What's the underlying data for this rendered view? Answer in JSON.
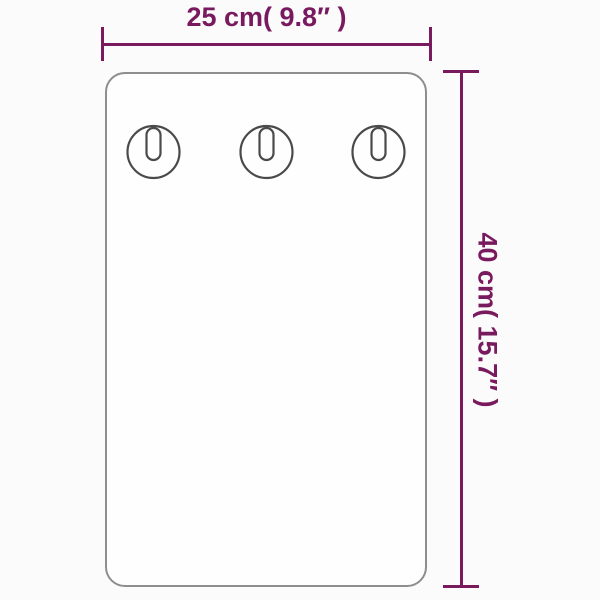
{
  "diagram": {
    "horizontal_dimension": {
      "label": "25 cm( 9.8″ )",
      "cm": "25 cm",
      "inches": "9.8″"
    },
    "vertical_dimension": {
      "label": "40 cm( 15.7″ )",
      "cm": "40 cm",
      "inches": "15.7″"
    },
    "keyhole_count": 3,
    "colors": {
      "dimension": "#7A1A5E",
      "panel-border": "#8E8E8E",
      "keyhole": "#4A4A4A",
      "background": "#FBFBFB",
      "panel-fill": "#FEFEFE"
    }
  }
}
